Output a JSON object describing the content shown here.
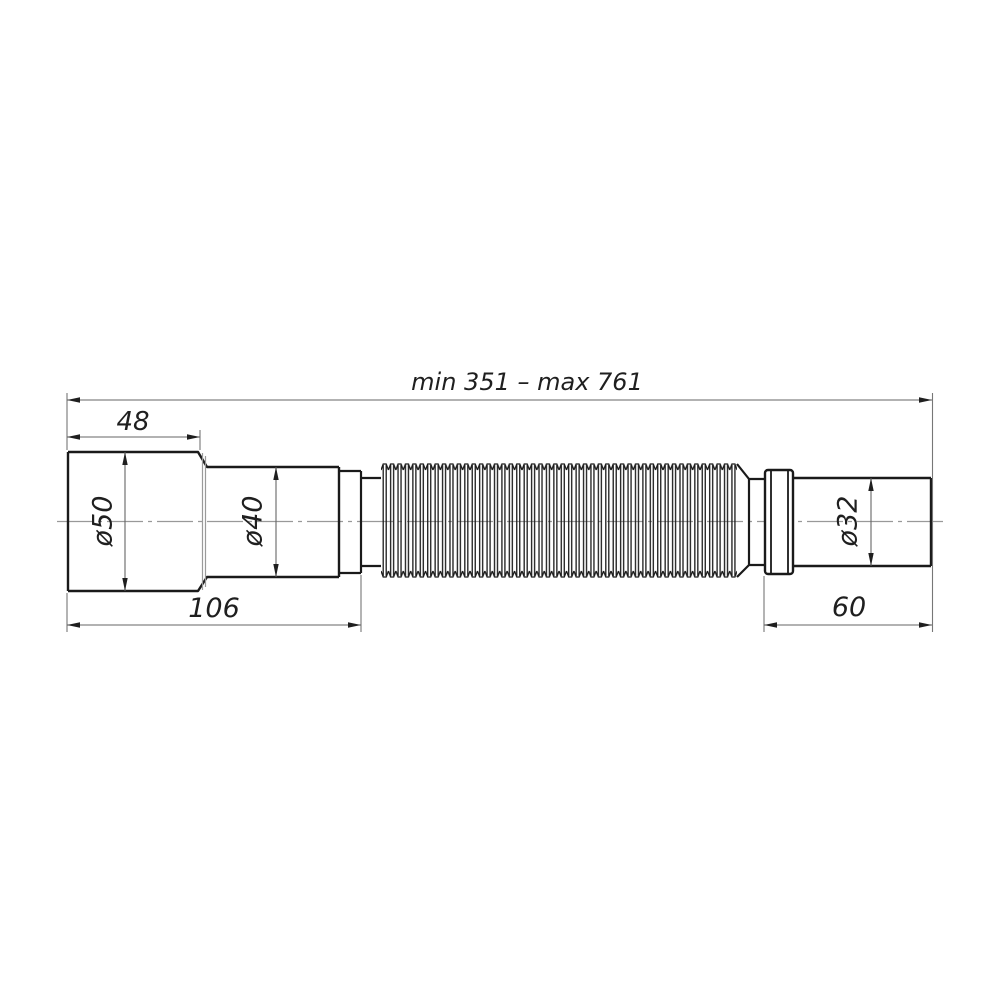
{
  "diagram": {
    "type": "technical-drawing",
    "subject": "flexible-corrugated-pipe",
    "overall_length": {
      "label": "min 351 – max 761",
      "min_mm": 351,
      "max_mm": 761
    },
    "segments": {
      "inlet_length": {
        "label": "48",
        "mm": 48
      },
      "body_length": {
        "label": "106",
        "mm": 106
      },
      "outlet_length": {
        "label": "60",
        "mm": 60
      },
      "inlet_diameter": {
        "label": "ø50",
        "mm": 50
      },
      "middle_diameter": {
        "label": "ø40",
        "mm": 40
      },
      "outlet_diameter": {
        "label": "ø32",
        "mm": 32
      }
    },
    "colors": {
      "outline": "#1a1a1a",
      "dimension_line": "#666666",
      "centerline": "#999999",
      "text": "#1f1f1f",
      "background": "#ffffff"
    }
  }
}
